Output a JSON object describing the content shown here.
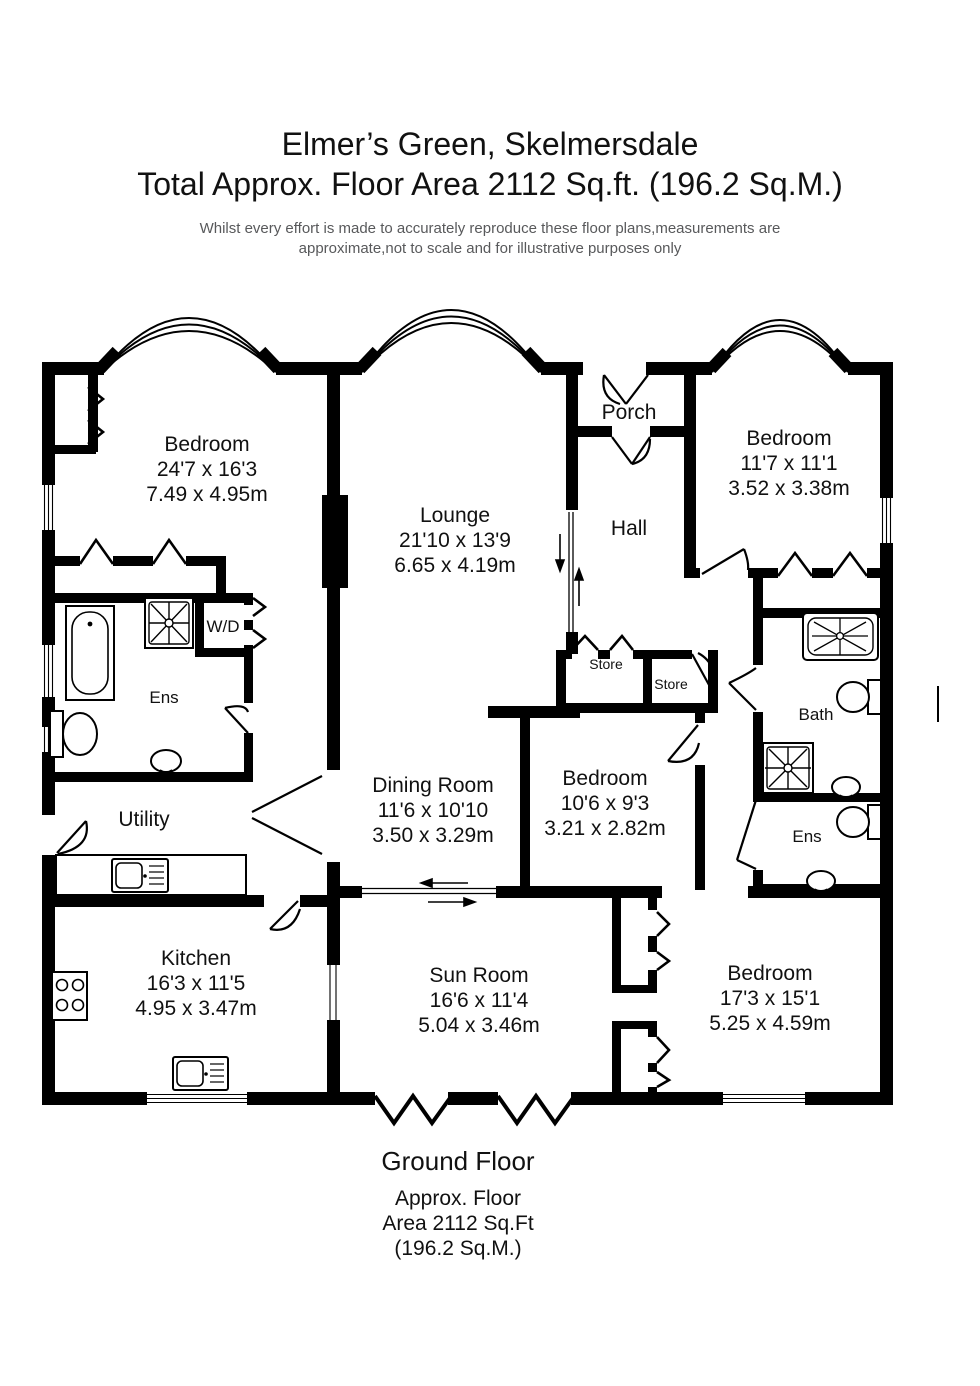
{
  "header": {
    "title": "Elmer’s Green, Skelmersdale",
    "subtitle": "Total Approx. Floor Area 2112 Sq.ft. (196.2 Sq.M.)",
    "disclaimer_line1": "Whilst every effort is made to accurately reproduce these floor plans,measurements are",
    "disclaimer_line2": "approximate,not to scale and for illustrative purposes only"
  },
  "rooms": {
    "bedroom1": {
      "name": "Bedroom",
      "imperial": "24'7 x 16'3",
      "metric": "7.49 x 4.95m"
    },
    "lounge": {
      "name": "Lounge",
      "imperial": "21'10 x 13'9",
      "metric": "6.65 x 4.19m"
    },
    "porch": {
      "name": "Porch"
    },
    "hall": {
      "name": "Hall"
    },
    "bedroom2": {
      "name": "Bedroom",
      "imperial": "11'7 x 11'1",
      "metric": "3.52 x 3.38m"
    },
    "ens1": {
      "name": "Ens"
    },
    "wd": {
      "name": "W/D"
    },
    "store1": {
      "name": "Store"
    },
    "store2": {
      "name": "Store"
    },
    "bath": {
      "name": "Bath"
    },
    "ens2": {
      "name": "Ens"
    },
    "utility": {
      "name": "Utility"
    },
    "dining": {
      "name": "Dining Room",
      "imperial": "11'6 x 10'10",
      "metric": "3.50 x 3.29m"
    },
    "bedroom3": {
      "name": "Bedroom",
      "imperial": "10'6 x 9'3",
      "metric": "3.21 x 2.82m"
    },
    "kitchen": {
      "name": "Kitchen",
      "imperial": "16'3 x 11'5",
      "metric": "4.95 x 3.47m"
    },
    "sunroom": {
      "name": "Sun Room",
      "imperial": "16'6 x 11'4",
      "metric": "5.04 x 3.46m"
    },
    "bedroom4": {
      "name": "Bedroom",
      "imperial": "17'3 x 15'1",
      "metric": "5.25 x 4.59m"
    }
  },
  "footer": {
    "floor_label": "Ground Floor",
    "area_line1": "Approx. Floor",
    "area_line2": "Area 2112 Sq.Ft",
    "area_line3": "(196.2 Sq.M.)"
  },
  "fixtures": [
    "bathtub",
    "shower",
    "toilet",
    "basin",
    "sink-drainer-unit",
    "hob",
    "counter"
  ],
  "colors": {
    "wall": "#000000",
    "text": "#111111",
    "disclaimer": "#58595b",
    "background": "#ffffff"
  }
}
